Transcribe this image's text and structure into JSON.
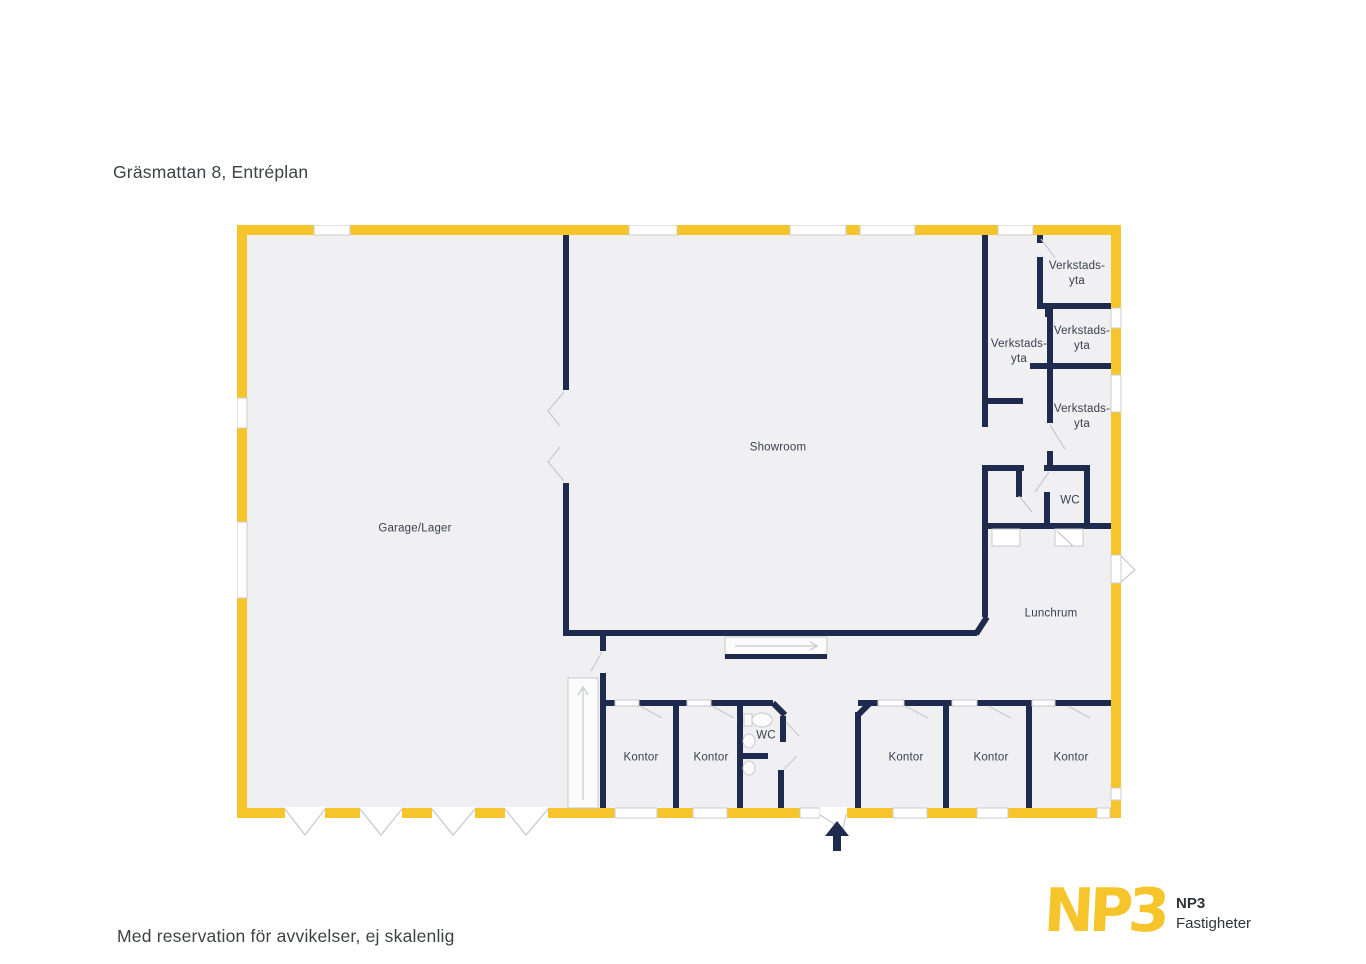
{
  "title": "Gräsmattan 8, Entréplan",
  "footer_note": "Med reservation för avvikelser, ej skalenlig",
  "logo": {
    "mark": "NP3",
    "name_line1": "NP3",
    "name_line2": "Fastigheter"
  },
  "colors": {
    "outer_wall_yellow": "#F6C52B",
    "interior_wall_navy": "#1F2B4E",
    "floor_fill": "#F0F0F2",
    "label_text": "#3A4050",
    "door_swing_gray": "#C5C9CE",
    "logo_yellow": "#F6C52B"
  },
  "rooms": [
    {
      "id": "garage",
      "label": "Garage/Lager"
    },
    {
      "id": "showroom",
      "label": "Showroom"
    },
    {
      "id": "verkstad-top",
      "label": "Verkstads-\nyta"
    },
    {
      "id": "verkstad-corridor",
      "label": "Verkstads-\nyta"
    },
    {
      "id": "verkstad-mid",
      "label": "Verkstads-\nyta"
    },
    {
      "id": "verkstad-low",
      "label": "Verkstads-\nyta"
    },
    {
      "id": "wc-right",
      "label": "WC"
    },
    {
      "id": "lunchrum",
      "label": "Lunchrum"
    },
    {
      "id": "kontor-1",
      "label": "Kontor"
    },
    {
      "id": "kontor-2",
      "label": "Kontor"
    },
    {
      "id": "wc-bottom",
      "label": "WC"
    },
    {
      "id": "kontor-3",
      "label": "Kontor"
    },
    {
      "id": "kontor-4",
      "label": "Kontor"
    },
    {
      "id": "kontor-5",
      "label": "Kontor"
    }
  ]
}
